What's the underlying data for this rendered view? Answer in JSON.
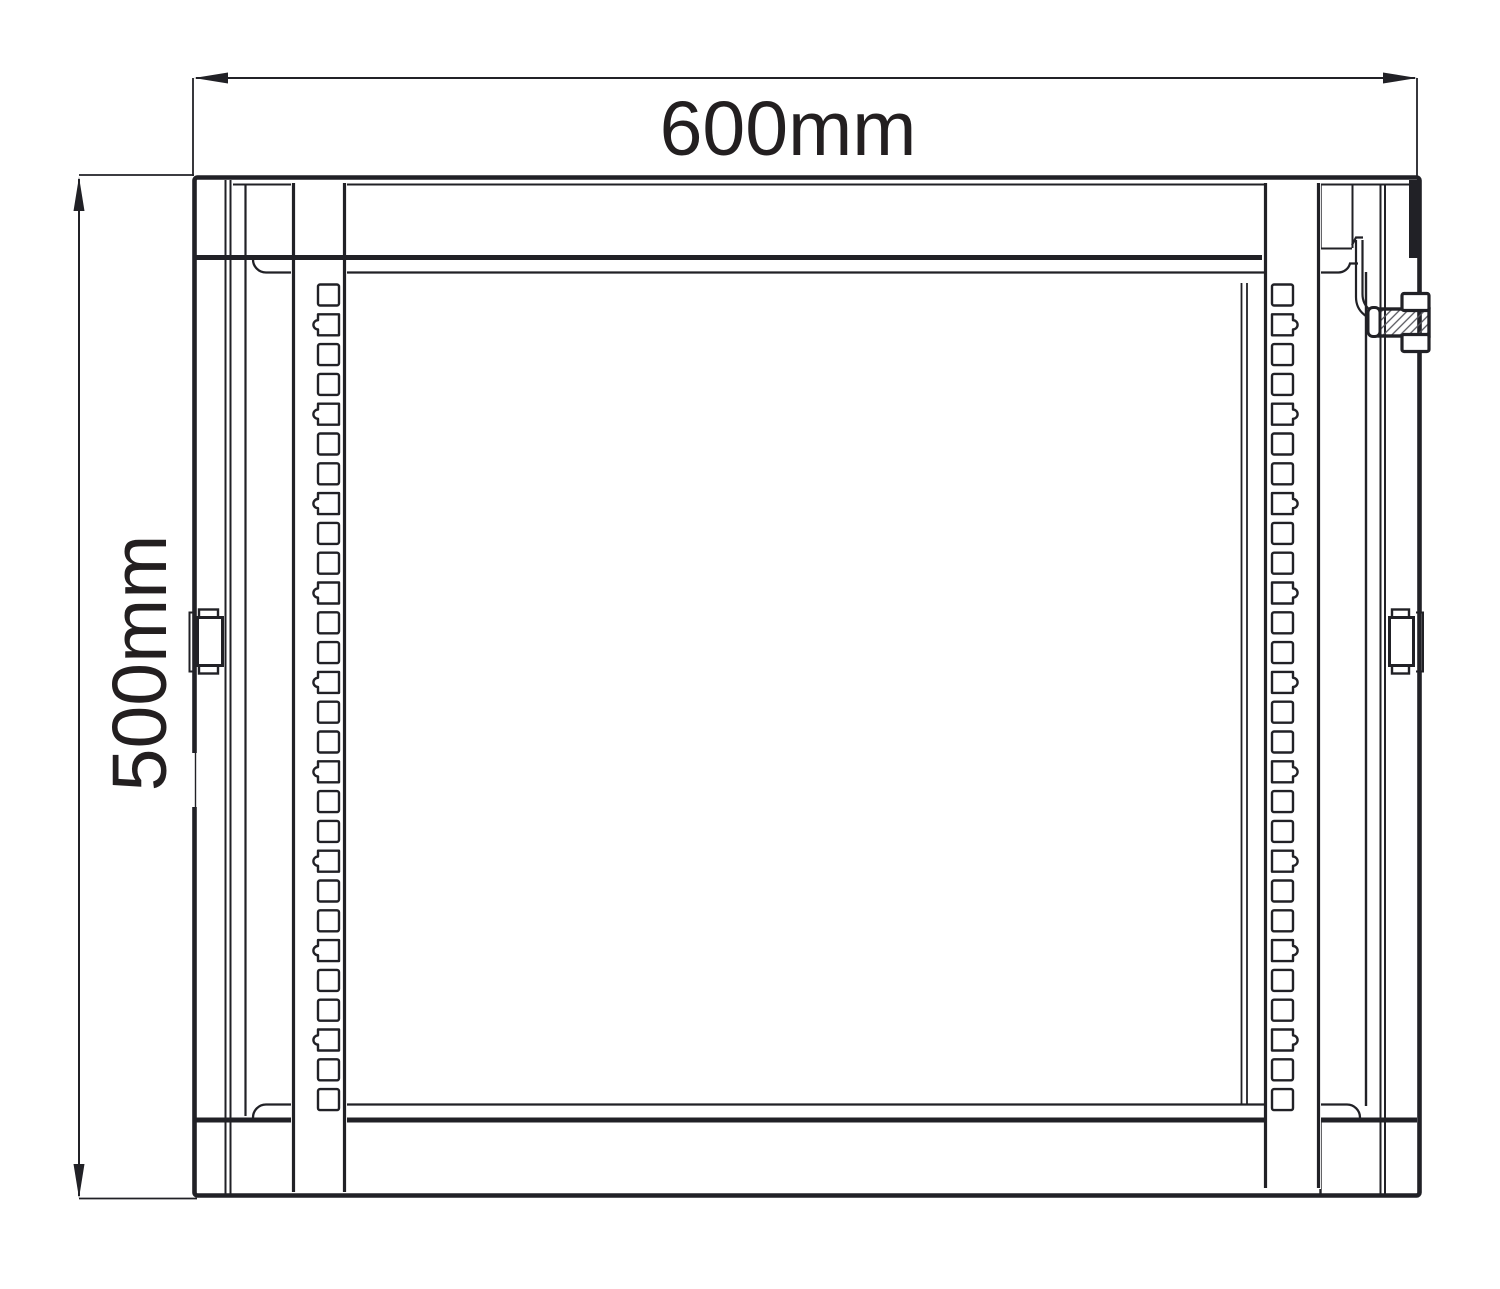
{
  "page": {
    "background": "#ffffff",
    "line_color": "#212126",
    "text_color": "#231f20"
  },
  "diagram": {
    "type": "technical-drawing",
    "subject": "wall-mount rack cabinet section view",
    "dimensions": {
      "width_label": "600mm",
      "height_label": "500mm"
    },
    "rails": {
      "hole_count": 28,
      "first_center_y": 295,
      "spacing": 29.8,
      "hole_size": 21,
      "notch_radius": 4.6,
      "notch_every": 3,
      "first_notch_index": 1,
      "left_hole_x": 318,
      "right_hole_x": 1272,
      "hole_pattern_unit": [
        "square",
        "notched",
        "square"
      ]
    }
  }
}
